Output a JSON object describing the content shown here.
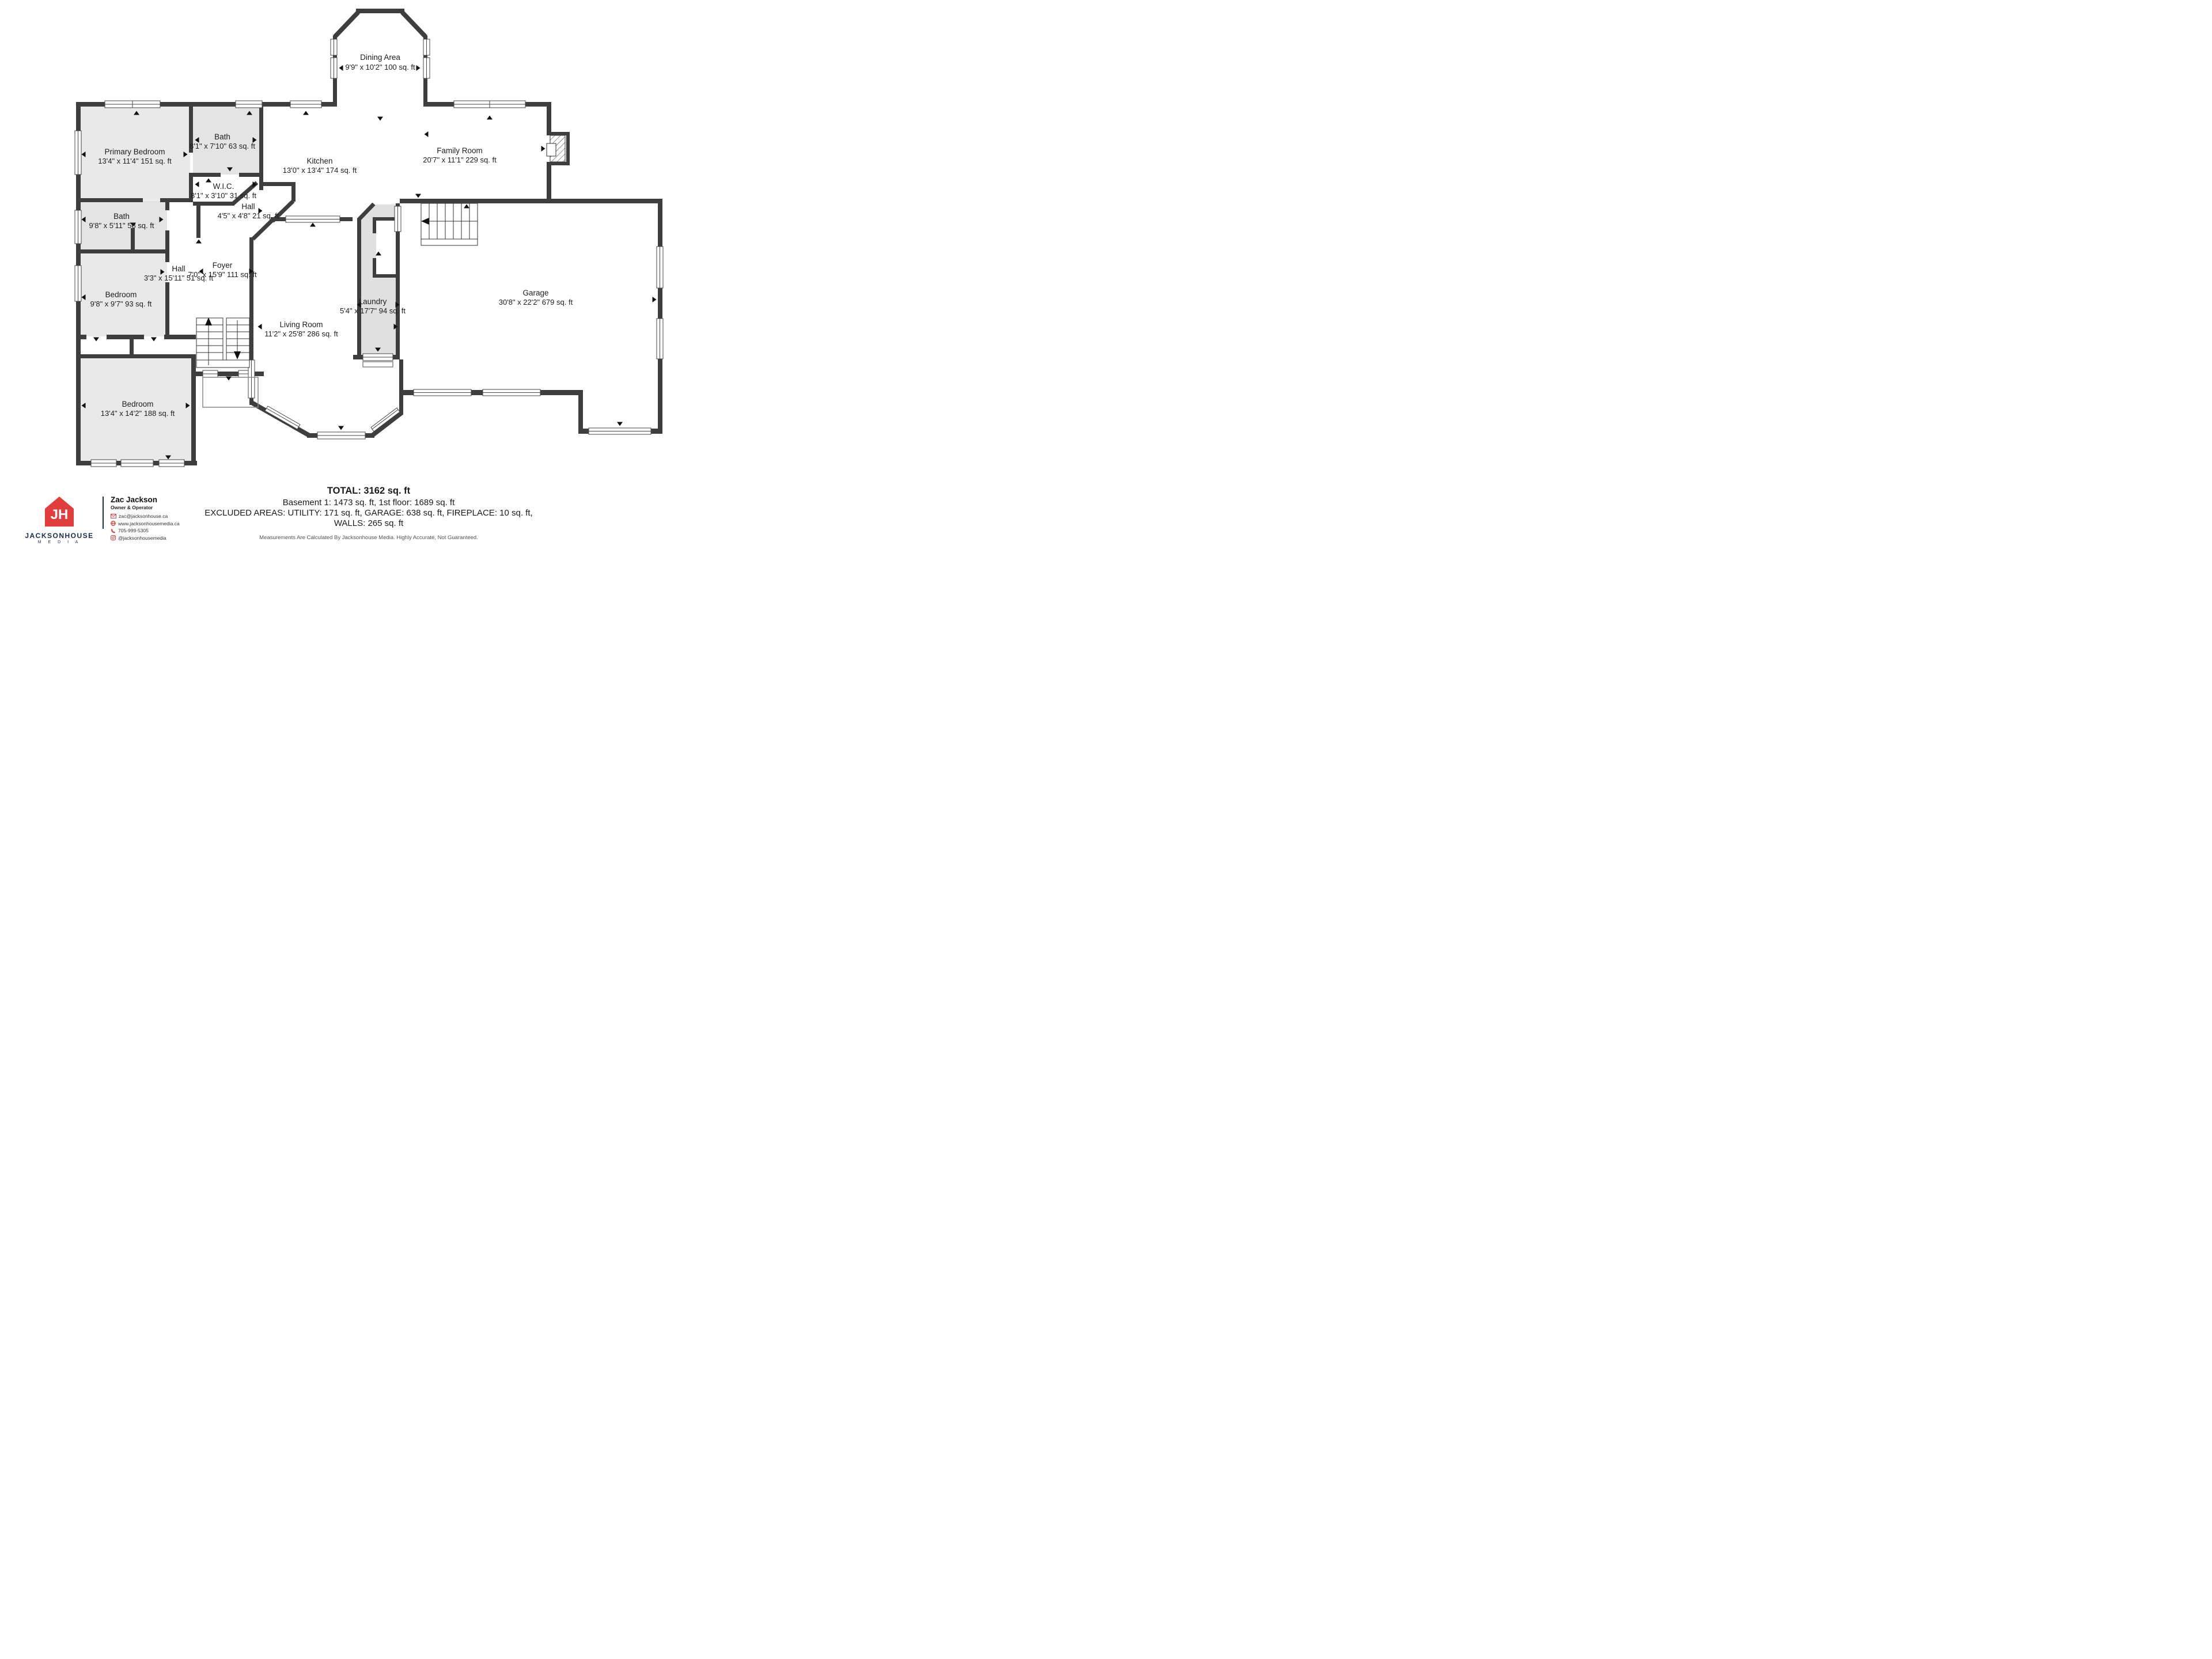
{
  "plan": {
    "colors": {
      "wall": "#3e3e3e",
      "room_fill": "#e9e9e9",
      "arrow": "#111111"
    },
    "rooms": [
      {
        "id": "dining",
        "name": "Dining Area",
        "dims": "9'9\" x 10'2\" 100 sq. ft"
      },
      {
        "id": "primary",
        "name": "Primary Bedroom",
        "dims": "13'4\" x 11'4\" 151 sq. ft"
      },
      {
        "id": "bath-top",
        "name": "Bath",
        "dims": "8'1\" x 7'10\" 63 sq. ft"
      },
      {
        "id": "kitchen",
        "name": "Kitchen",
        "dims": "13'0\" x 13'4\" 174 sq. ft"
      },
      {
        "id": "family",
        "name": "Family Room",
        "dims": "20'7\" x 11'1\" 229 sq. ft"
      },
      {
        "id": "wic",
        "name": "W.I.C.",
        "dims": "8'1\" x 3'10\" 31 sq. ft"
      },
      {
        "id": "hall-small",
        "name": "Hall",
        "dims": "4'5\" x 4'8\" 21 sq. ft"
      },
      {
        "id": "bath-left",
        "name": "Bath",
        "dims": "9'8\" x 5'11\" 58 sq. ft"
      },
      {
        "id": "hall",
        "name": "Hall",
        "dims": "3'3\" x 15'11\" 51 sq. ft"
      },
      {
        "id": "foyer",
        "name": "Foyer",
        "dims": "7'0\" x 15'9\" 111 sq. ft"
      },
      {
        "id": "bedroom-left",
        "name": "Bedroom",
        "dims": "9'8\" x 9'7\" 93 sq. ft"
      },
      {
        "id": "laundry",
        "name": "Laundry",
        "dims": "5'4\" x 17'7\" 94 sq. ft"
      },
      {
        "id": "garage",
        "name": "Garage",
        "dims": "30'8\" x 22'2\" 679 sq. ft"
      },
      {
        "id": "living",
        "name": "Living Room",
        "dims": "11'2\" x 25'8\" 286 sq. ft"
      },
      {
        "id": "bedroom-bottom",
        "name": "Bedroom",
        "dims": "13'4\" x 14'2\" 188 sq. ft"
      }
    ]
  },
  "summary": {
    "total": "TOTAL: 3162 sq. ft",
    "floors": "Basement 1: 1473 sq. ft, 1st floor: 1689 sq. ft",
    "excluded": "EXCLUDED AREAS: UTILITY: 171 sq. ft, GARAGE: 638 sq. ft, FIREPLACE: 10 sq. ft,",
    "walls": "WALLS: 265 sq. ft",
    "disclaimer": "Measurements Are Calculated By Jacksonhouse Media. Highly Accurate, Not Guaranteed."
  },
  "branding": {
    "monogram": "JH",
    "company": "JACKSONHOUSE",
    "company_sub": "M E D I A",
    "agent": "Zac Jackson",
    "title": "Owner & Operator",
    "email": "zac@jacksonhouse.ca",
    "website": "www.jacksonhousemedia.ca",
    "phone": "705-999-5305",
    "instagram": "@jacksonhousemedia",
    "red": "#e23d3d",
    "navy": "#1e2a4d"
  }
}
